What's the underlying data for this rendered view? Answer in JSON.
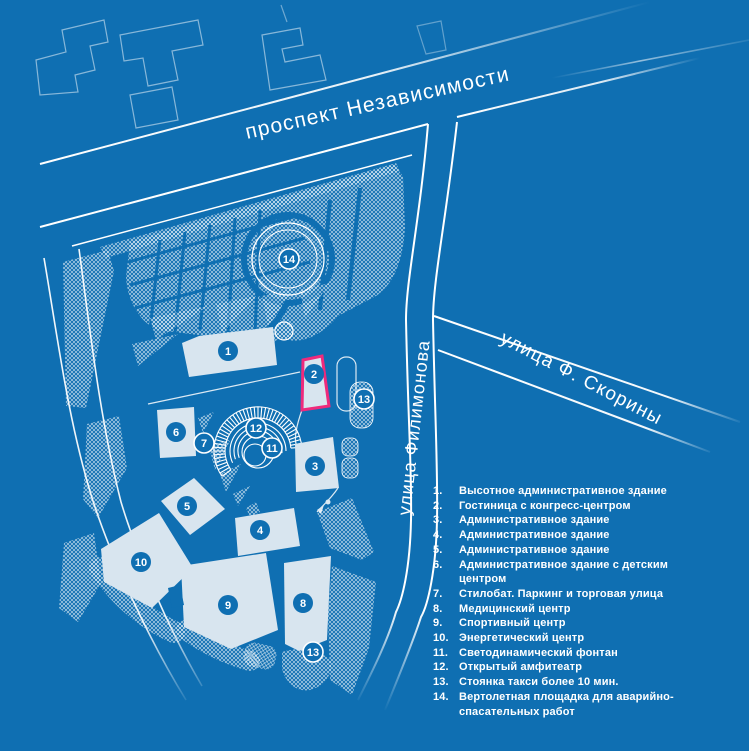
{
  "map": {
    "colors": {
      "background": "#0f6fb2",
      "line": "#ffffff",
      "building_fill": "#d8e5ef",
      "highlight_outline": "#ee2a7c",
      "badge_fill": "#0f6fb2"
    },
    "streets": {
      "nezavisimosti": "проспект Независимости",
      "filimonova": "улица Филимонова",
      "skoriny": "улица Ф. Скорины"
    },
    "badges": [
      {
        "n": "1",
        "x": 228,
        "y": 351,
        "ring": false
      },
      {
        "n": "2",
        "x": 314,
        "y": 374,
        "ring": false
      },
      {
        "n": "3",
        "x": 315,
        "y": 466,
        "ring": false
      },
      {
        "n": "4",
        "x": 260,
        "y": 530,
        "ring": false
      },
      {
        "n": "5",
        "x": 187,
        "y": 506,
        "ring": false
      },
      {
        "n": "6",
        "x": 176,
        "y": 432,
        "ring": false
      },
      {
        "n": "7",
        "x": 204,
        "y": 443,
        "ring": true
      },
      {
        "n": "8",
        "x": 303,
        "y": 603,
        "ring": false
      },
      {
        "n": "9",
        "x": 228,
        "y": 605,
        "ring": false
      },
      {
        "n": "10",
        "x": 141,
        "y": 562,
        "ring": false
      },
      {
        "n": "11",
        "x": 272,
        "y": 448,
        "ring": true
      },
      {
        "n": "12",
        "x": 256,
        "y": 428,
        "ring": true
      },
      {
        "n": "13",
        "x": 364,
        "y": 399,
        "ring": true
      },
      {
        "n": "13",
        "x": 313,
        "y": 652,
        "ring": true
      },
      {
        "n": "14",
        "x": 289,
        "y": 259,
        "ring": true
      }
    ]
  },
  "legend": {
    "items": [
      {
        "num": "1.",
        "label": "Высотное административное здание"
      },
      {
        "num": "2.",
        "label": "Гостиница с конгресс-центром"
      },
      {
        "num": "3.",
        "label": "Административное здание"
      },
      {
        "num": "4.",
        "label": "Административное здание"
      },
      {
        "num": "5.",
        "label": "Административное здание"
      },
      {
        "num": "6.",
        "label": "Административное здание с детским центром"
      },
      {
        "num": "7.",
        "label": "Стилобат. Паркинг и торговая улица"
      },
      {
        "num": "8.",
        "label": "Медицинский центр"
      },
      {
        "num": "9.",
        "label": "Спортивный центр"
      },
      {
        "num": "10.",
        "label": "Энергетический центр"
      },
      {
        "num": "11.",
        "label": "Светодинамический фонтан"
      },
      {
        "num": "12.",
        "label": "Открытый амфитеатр"
      },
      {
        "num": "13.",
        "label": "Стоянка такси более 10 мин."
      },
      {
        "num": "14.",
        "label": "Вертолетная площадка для аварийно-спасательных работ"
      }
    ]
  }
}
